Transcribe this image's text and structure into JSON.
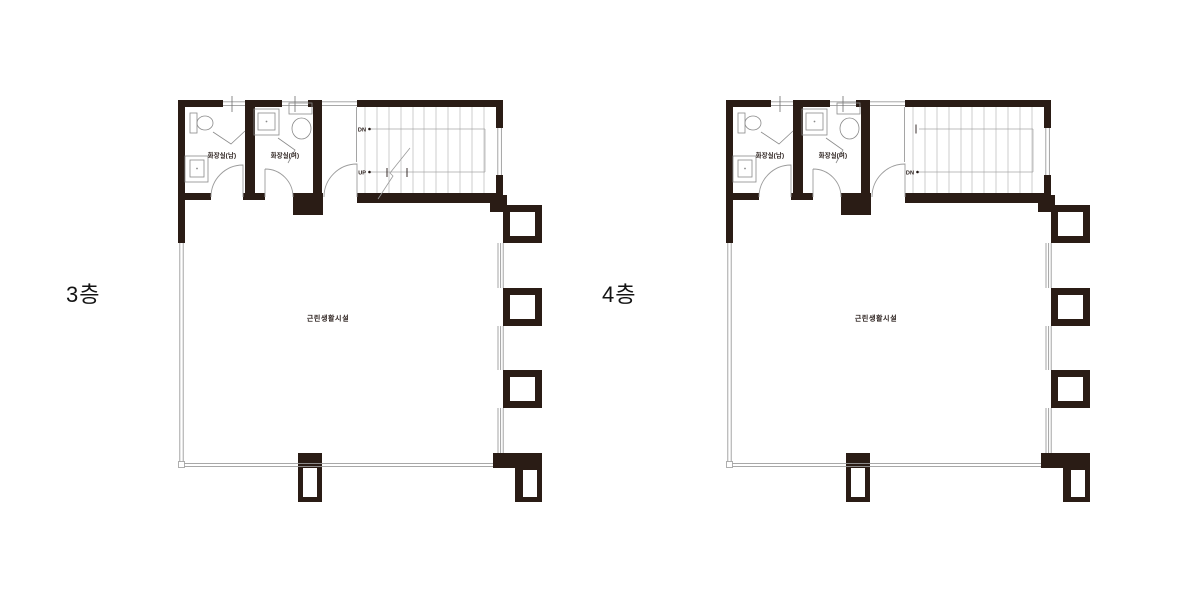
{
  "sheet": {
    "background": "#ffffff"
  },
  "colors": {
    "wall": "#2a1c15",
    "thin_line": "#9c9c9c",
    "stair_line": "#b8b8b8",
    "fixture_line": "#8a8a8a",
    "text": "#231815"
  },
  "plans": [
    {
      "floor_label": "3층",
      "room_label": "근린생활시설",
      "toilet_men": "화장실(남)",
      "toilet_women": "화장실(여)",
      "stair_top_label": "DN",
      "stair_bottom_label": "UP"
    },
    {
      "floor_label": "4층",
      "room_label": "근린생활시설",
      "toilet_men": "화장실(남)",
      "toilet_women": "화장실(여)",
      "stair_top_label": "",
      "stair_bottom_label": "DN"
    }
  ]
}
